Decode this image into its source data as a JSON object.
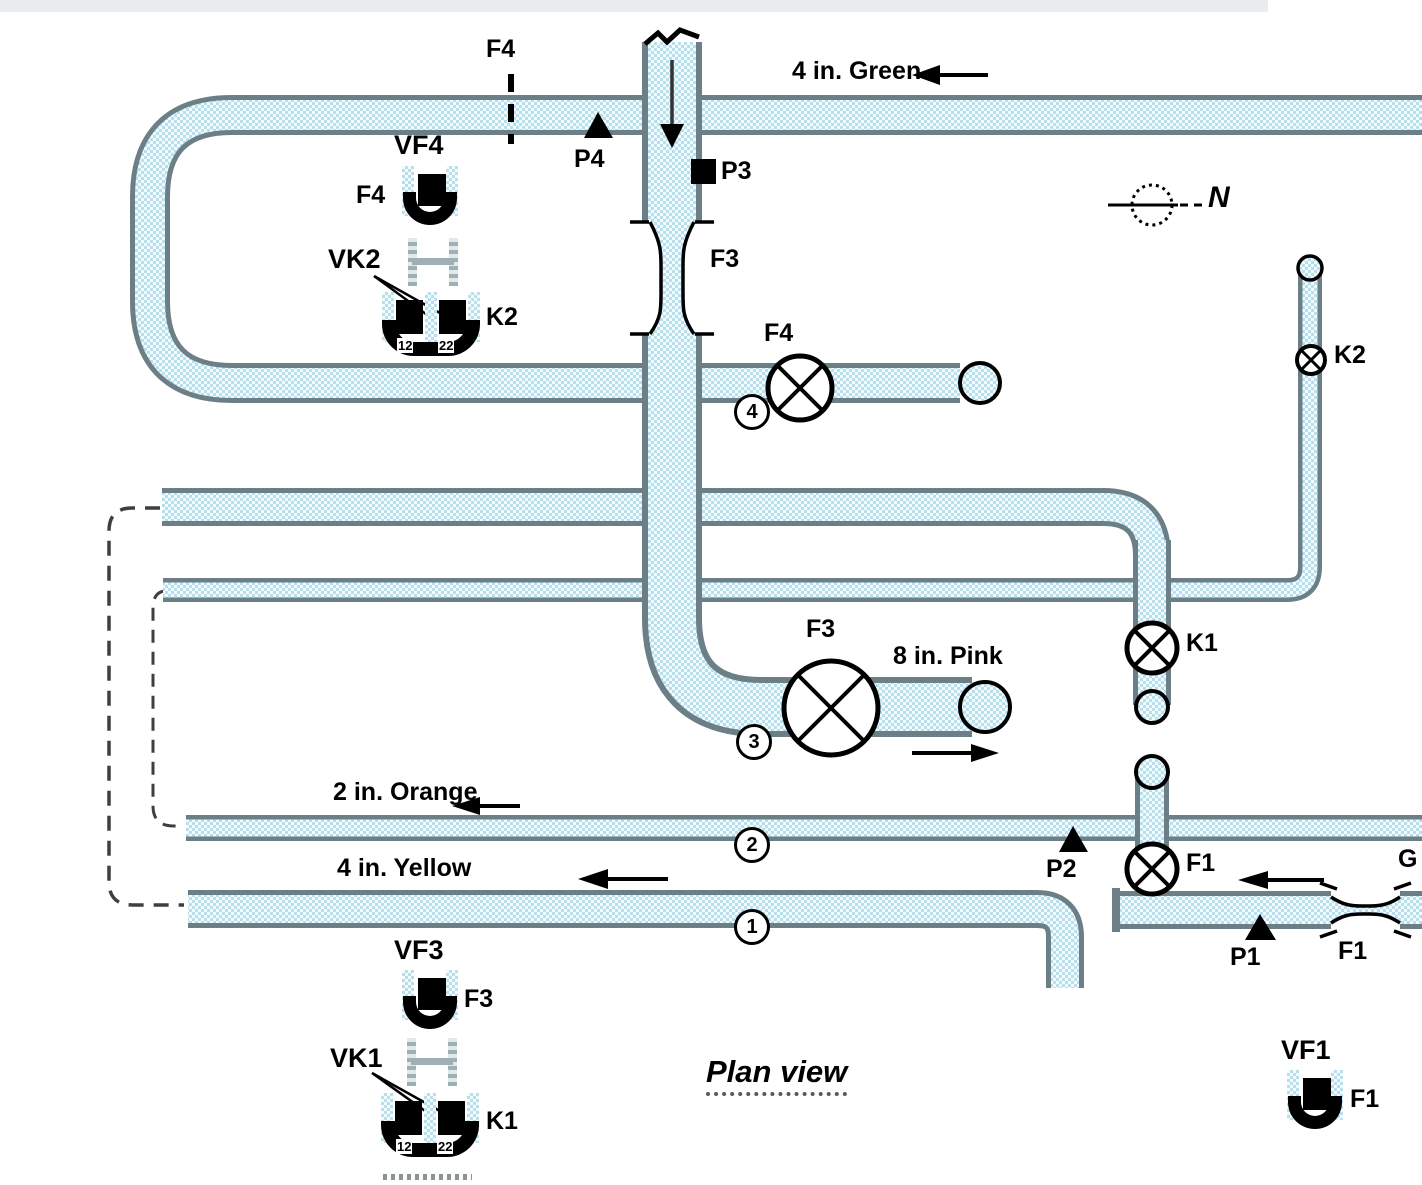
{
  "title": "Plan view",
  "compass": {
    "label": "N"
  },
  "colors": {
    "pipe_fill": "#b9dfec",
    "pipe_check": "#f3fbfd",
    "pipe_border": "#6d7f86",
    "ink": "#000000",
    "hidden_line": "#3f3f3f",
    "hatch_gray": "#9fb0b5"
  },
  "lines": [
    {
      "number": "1",
      "label": "4 in. Yellow",
      "flow": "west"
    },
    {
      "number": "2",
      "label": "2 in. Orange",
      "flow": "west"
    },
    {
      "number": "3",
      "label": "8 in. Pink",
      "flow": "east"
    },
    {
      "number": "4",
      "label": "4 in. Green",
      "flow": "west"
    }
  ],
  "labels": {
    "green_line": "4 in. Green",
    "orange_line": "2 in. Orange",
    "yellow_line": "4 in. Yellow",
    "pink_line": "8 in. Pink",
    "g_cutoff": "G",
    "line1_num": "1",
    "line2_num": "2",
    "line3_num": "3",
    "line4_num": "4",
    "f4_orifice": "F4",
    "f3_venturi": "F3",
    "f1_venturi": "F1",
    "f4_valve": "F4",
    "f3_valve": "F3",
    "f1_valve": "F1",
    "k1_valve": "K1",
    "k2_valve": "K2",
    "p1": "P1",
    "p2": "P2",
    "p3": "P3",
    "p4": "P4",
    "vf1": "VF1",
    "vf3": "VF3",
    "vf4": "VF4",
    "vk1": "VK1",
    "vk2": "VK2",
    "vf1_meter": "F1",
    "vf3_meter": "F3",
    "vf4_meter": "F4",
    "k1_meter": "K1",
    "k2_meter": "K2",
    "k_sub_left": "12",
    "k_sub_right": "22",
    "north": "N",
    "title": "Plan view"
  }
}
